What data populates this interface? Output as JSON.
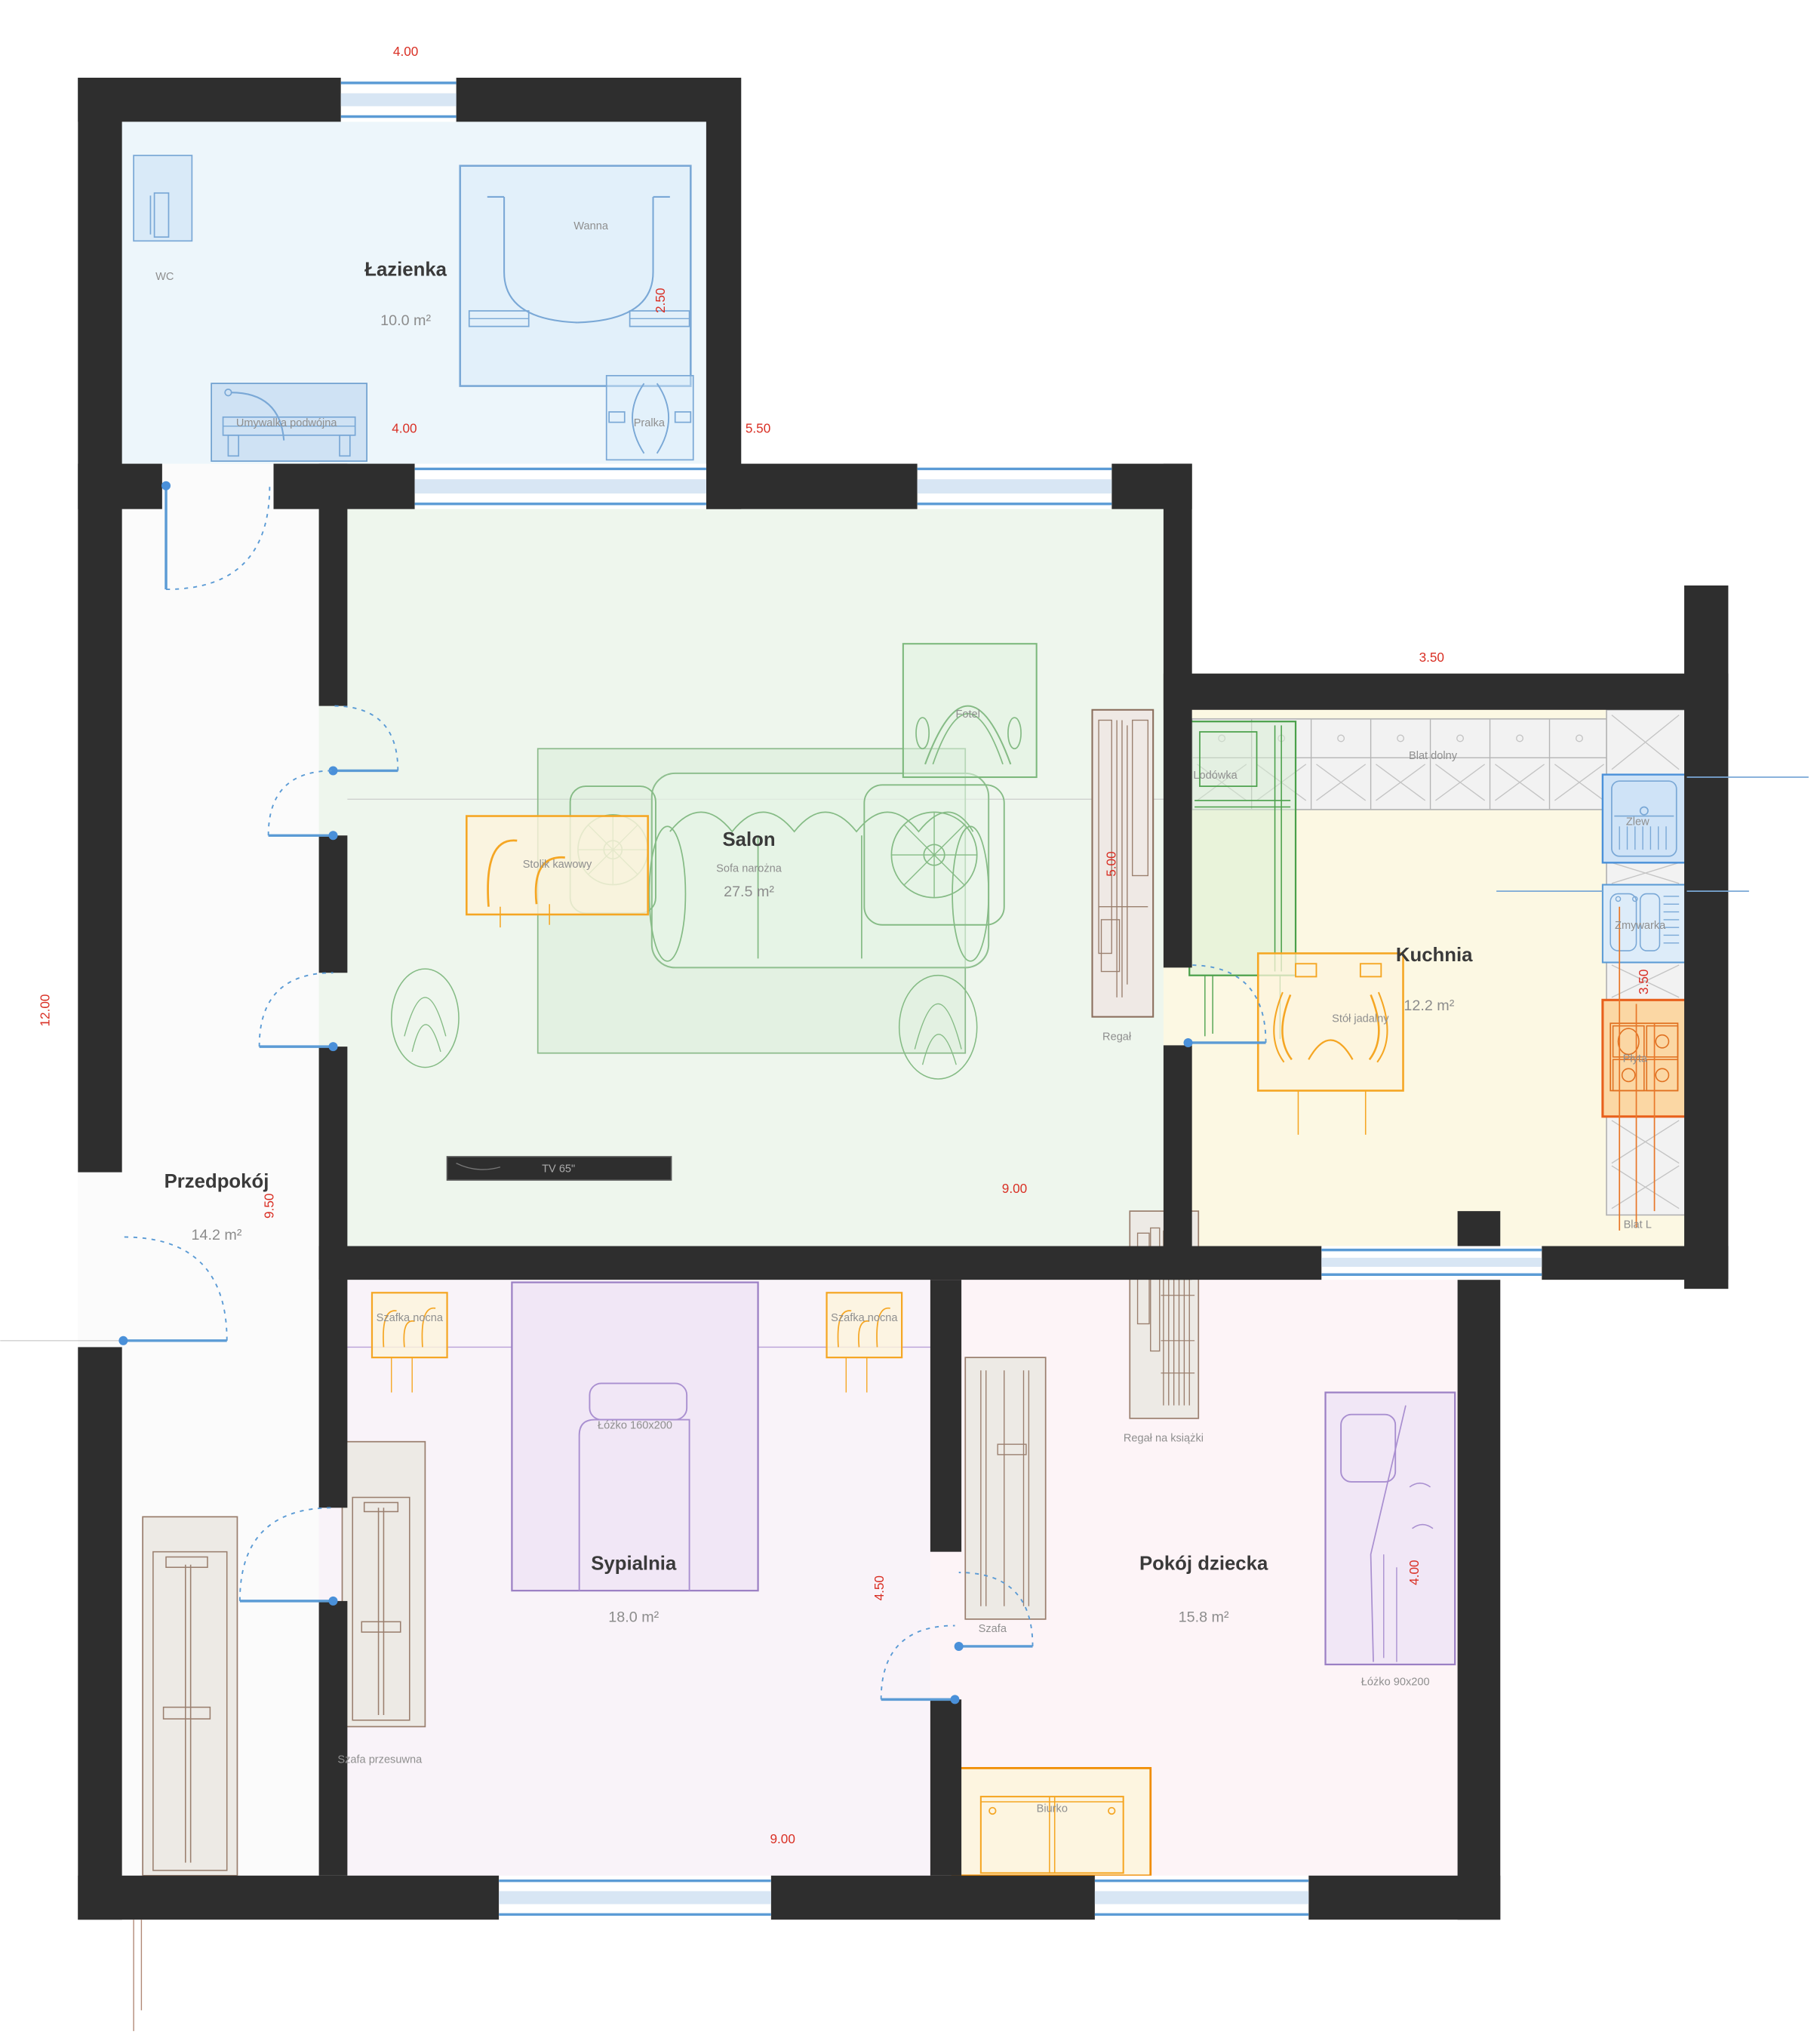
{
  "rooms": {
    "lazienka": {
      "name": "Łazienka",
      "area": "10.0 m²"
    },
    "salon": {
      "name": "Salon",
      "area": "27.5 m²"
    },
    "kuchnia": {
      "name": "Kuchnia",
      "area": "12.2 m²"
    },
    "przedpokoj": {
      "name": "Przedpokój",
      "area": "14.2 m²"
    },
    "sypialnia": {
      "name": "Sypialnia",
      "area": "18.0 m²"
    },
    "pokoj_dziecka": {
      "name": "Pokój dziecka",
      "area": "15.8 m²"
    }
  },
  "furniture": {
    "wc": "WC",
    "wanna": "Wanna",
    "umywalka": "Umywalka podwójna",
    "pralka": "Pralka",
    "sofa": "Sofa narożna",
    "fotel": "Fotel",
    "stolik": "Stolik kawowy",
    "tv": "TV 65\"",
    "regal": "Regał",
    "lodowka": "Lodówka",
    "blat_dolny": "Blat dolny",
    "zlew": "Zlew",
    "zmywarka": "Zmywarka",
    "plyta": "Płyta",
    "blat_l": "Blat L",
    "stol": "Stół jadalny",
    "szafka_nocna": "Szafka nocna",
    "lozko160": "Łóżko 160x200",
    "szafa_przesuwna": "Szafa przesuwna",
    "szafa": "Szafa",
    "regal_ksiazki": "Regał na książki",
    "lozko90": "Łóżko 90x200",
    "biurko": "Biurko"
  },
  "dims": {
    "top_bath": "4.00",
    "bath_h": "2.50",
    "bath_w": "4.00",
    "right_bath": "5.50",
    "kitchen_top": "3.50",
    "regal_h": "5.00",
    "kitchen_right": "3.50",
    "left_total": "12.00",
    "przedpokoj_h": "9.50",
    "salon_w": "9.00",
    "bedroom_door": "4.50",
    "child_bed": "4.00",
    "bottom": "9.00"
  },
  "colors": {
    "wall": "#2e2e2e",
    "dim_red": "#d93025",
    "door_blue": "#5b9bd5",
    "floor_lazienka": "#edf6fb",
    "floor_salon": "#eef6ed",
    "floor_kuchnia": "#fcf8e3",
    "floor_przedpokoj": "#fbfbfb",
    "floor_sypialnia": "#f9f3f9",
    "floor_pokoj_dziecka": "#fdf4f7",
    "furniture_orange": "#f5a623",
    "furniture_green": "#7cb87c",
    "furniture_purple": "#9b7fc4",
    "furniture_blue": "#4a90d9",
    "counter_gray": "#b5b5b5",
    "wood_brown": "#9a7f6e",
    "hob_red": "#e8601c"
  }
}
